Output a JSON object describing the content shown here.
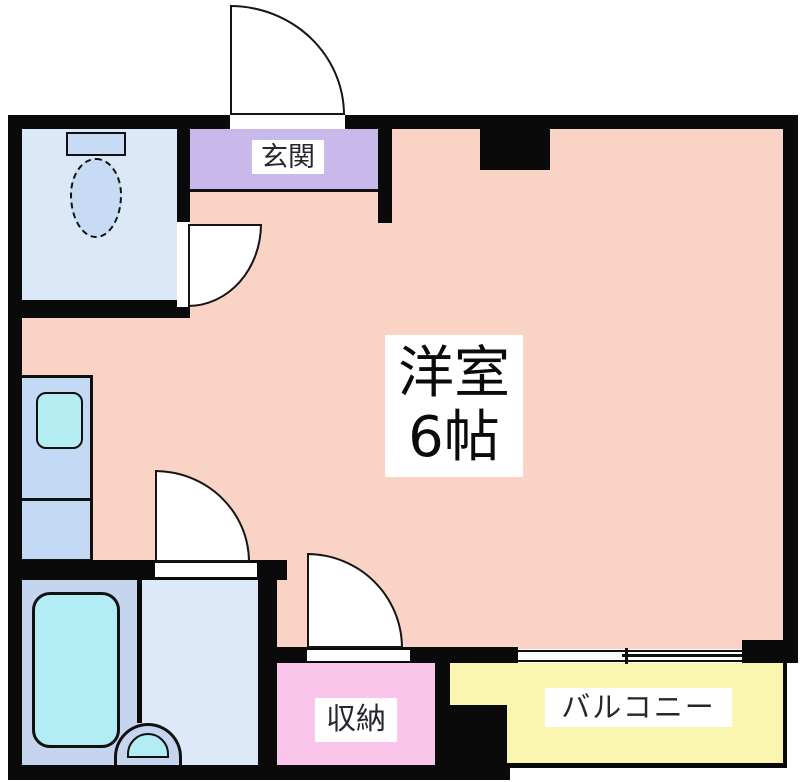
{
  "plan": {
    "type": "apartment-floor-plan",
    "rooms": {
      "main": {
        "label_line1": "洋室",
        "label_line2": "6帖",
        "color": "#f9d3c5"
      },
      "entrance": {
        "label": "玄関",
        "color": "#c9b9ea"
      },
      "storage": {
        "label": "収納",
        "color": "#f9c5eb"
      },
      "balcony": {
        "label": "バルコニー",
        "color": "#fbf6af"
      },
      "toilet_room": {
        "color": "#dbe8f8"
      },
      "kitchen": {
        "color": "#c3d9f4"
      },
      "bathroom": {
        "color": "#c5d5ef"
      },
      "washroom": {
        "color": "#dde9f9"
      }
    },
    "fixtures": {
      "toilet": "toilet",
      "kitchen_sink": "kitchen-sink",
      "bathtub": "bathtub",
      "washbasin": "washbasin",
      "fixture_fill_color": "#b4eef3"
    },
    "colors": {
      "wall": "#0a0a0a",
      "label_background": "#ffffff",
      "label_text": "#26262e",
      "door_fill": "#ffffff"
    }
  }
}
